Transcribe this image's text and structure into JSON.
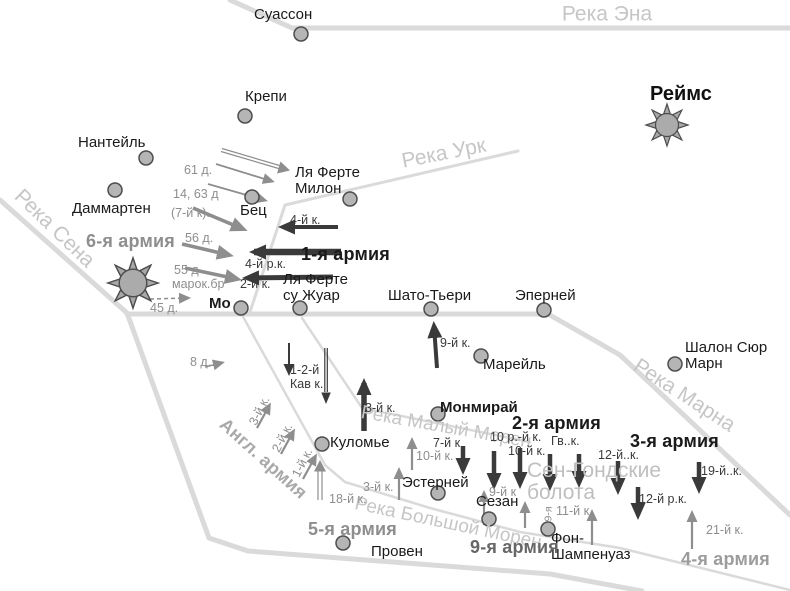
{
  "colors": {
    "river_line": "#dadada",
    "river_label": "#c6c6c6",
    "marsh_label": "#bfbfbf",
    "dark_unit": "#3a3a3a",
    "gray_unit": "#8e8e8e",
    "town_dot_fill": "#b5b5b5",
    "town_dot_stroke": "#4d4d4d",
    "text": "#1a1a1a"
  },
  "cities": {
    "reims": "Реймс",
    "soissons": "Суассон",
    "crepy": "Крепи",
    "nanteuil": "Нантейль",
    "dammartin": "Даммартен",
    "la_ferte_milon": "Ля Ферте Милон",
    "betz": "Бец",
    "meaux": "Мо",
    "la_ferte_sous_jouarre": "Ля Ферте су Жуар",
    "chateau_thierry": "Шато-Тьери",
    "epernay": "Эперней",
    "chalons": "Шалон Сюр Марн",
    "mareuil": "Марейль",
    "montmirail": "Монмирай",
    "coulommiers": "Куломье",
    "esternay": "Эстерней",
    "sezanne": "Сезан",
    "provins": "Провен",
    "fere_champenoise": "Фон-Шампенуаз"
  },
  "rivers": {
    "aisne": "Река Эна",
    "ourcq": "Река Урк",
    "seine": "Река Сена",
    "marne": "Река Марна",
    "petit_morin": "Река Малый Морен",
    "grand_morin": "Река Большой Морен"
  },
  "marsh": "Сен-Гондские болота",
  "armies": {
    "french6": "6-я армия",
    "german1": "1-я армия",
    "german2": "2-я армия",
    "german3": "3-я армия",
    "german4": "4-я армия",
    "french5": "5-я армия",
    "french9": "9-я армия",
    "british": "Англ. армия"
  },
  "units": {
    "d61": "61 д.",
    "d14_63": "14, 63 д",
    "k7_paren": "(7-й к).",
    "d56": "56 д.",
    "d55": "55 д",
    "marok": "марок.бр",
    "d45": "45 д.",
    "d8": "8 д.",
    "k4": "4-й к.",
    "rk4": "4-й р.к.",
    "k2": "2-й к.",
    "kav12": "1-2-й Кав к.",
    "k9_ct": "9-й к.",
    "k3_mont": "3-й к.",
    "k7_est": "7-й к",
    "k10_est": "10-й к.",
    "k3_brit": "3-й к.",
    "k2_brit": "2-й к.",
    "k1_brit": "1-й к.",
    "k18": "18-й к.",
    "k3_fr5": "3-й к.",
    "rk10": "10 р.-й к.",
    "k10_g2": "10-й к.",
    "gv": "Гв..к.",
    "k12": "12-й..к.",
    "k19": "19-й..к.",
    "rk12": "12-й р.к.",
    "k11": "11-й к",
    "k21": "21-й к.",
    "k9_sez": "9-й к",
    "rot9": "9-я"
  }
}
